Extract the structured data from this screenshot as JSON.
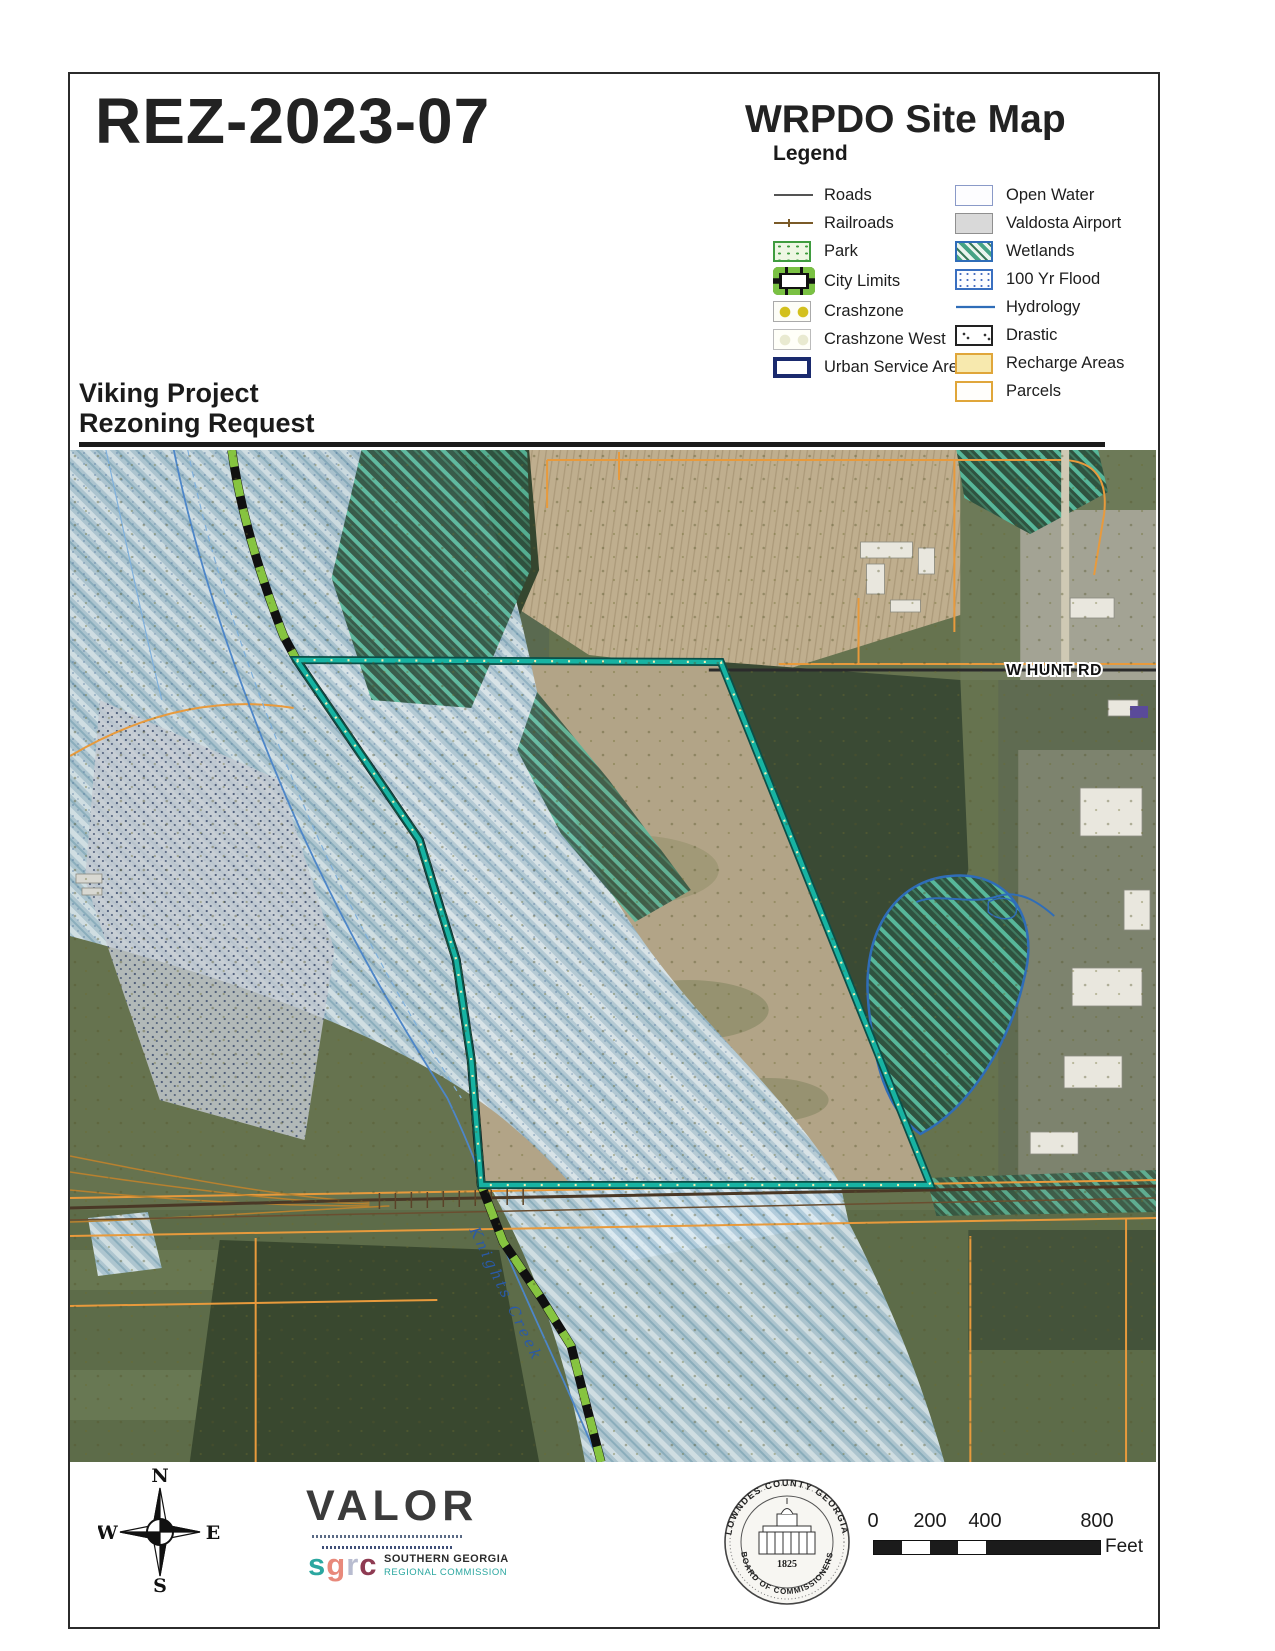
{
  "header": {
    "case_number": "REZ-2023-07",
    "map_title": "WRPDO Site Map",
    "legend_title": "Legend"
  },
  "legend": {
    "left": [
      {
        "label": "Roads"
      },
      {
        "label": "Railroads"
      },
      {
        "label": "Park"
      },
      {
        "label": "City Limits"
      },
      {
        "label": "Crashzone"
      },
      {
        "label": "Crashzone West"
      },
      {
        "label": "Urban Service Area"
      }
    ],
    "right": [
      {
        "label": "Open Water"
      },
      {
        "label": "Valdosta Airport"
      },
      {
        "label": "Wetlands"
      },
      {
        "label": "100 Yr Flood"
      },
      {
        "label": "Hydrology"
      },
      {
        "label": "Drastic"
      },
      {
        "label": "Recharge Areas"
      },
      {
        "label": "Parcels"
      }
    ]
  },
  "project": {
    "line1": "Viking Project",
    "line2": "Rezoning Request"
  },
  "map_labels": {
    "road": "W HUNT RD",
    "creek": "Knights Creek"
  },
  "compass": {
    "north": "N",
    "east": "E",
    "south": "S",
    "west": "W"
  },
  "valor": {
    "wordmark": "VALOR",
    "sgrc_s": "s",
    "sgrc_g": "g",
    "sgrc_r": "r",
    "sgrc_c": "c",
    "org_line1": "SOUTHERN GEORGIA",
    "org_line2": "REGIONAL COMMISSION"
  },
  "seal": {
    "top_text": "LOWNDES COUNTY GEORGIA",
    "bottom_text": "BOARD OF COMMISSIONERS",
    "year": "1825"
  },
  "scale_bar": {
    "ticks": [
      "0",
      "200",
      "400",
      "800"
    ],
    "unit": "Feet"
  },
  "colors": {
    "site_boundary_teal": "#17b3a2",
    "city_limits_green": "#86c440",
    "parcel_orange": "#e89a3c",
    "hydrology_blue": "#2f6db8",
    "urban_service_navy": "#1a2a6e",
    "flood_blue": "#b5cedd"
  }
}
